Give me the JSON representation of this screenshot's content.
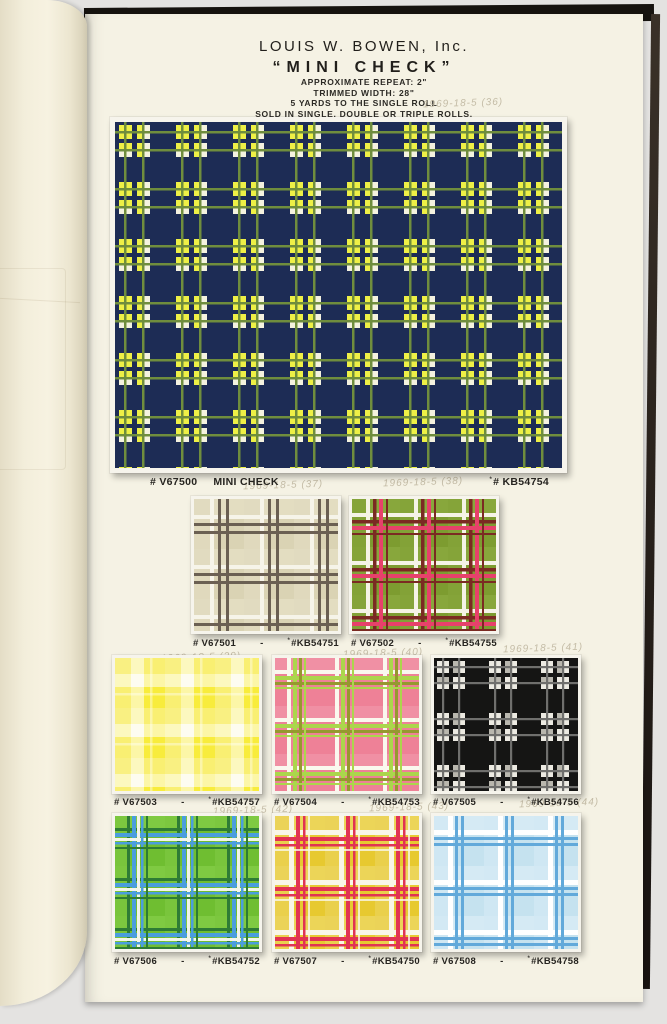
{
  "header": {
    "company": "LOUIS W. BOWEN, Inc.",
    "title": "“MINI CHECK”",
    "specs": [
      "APPROXIMATE REPEAT: 2\"",
      "TRIMMED WIDTH: 28\"",
      "5 YARDS TO THE SINGLE ROLL",
      "SOLD IN SINGLE, DOUBLE OR TRIPLE ROLLS."
    ],
    "footnote": "\"Kent Bragline, Inc. Correlated Fabrics Indicated by KB Numbers\""
  },
  "annotations": {
    "a36": "1969-18-5 (36)",
    "a37": "1969-18-5 (37)",
    "a38": "1969-18-5 (38)",
    "a39": "1969-18-5 (39)",
    "a40": "1969-18-5 (40)",
    "a41": "1969-18-5 (41)",
    "a42": "1969-18-5 (42)",
    "a43": "1969-18-5 (43)",
    "a44": "1969-18-5 (44)"
  },
  "main_swatch": {
    "v_number": "# V67500",
    "name": "MINI CHECK",
    "kb_mark": "*",
    "kb_number": "# KB54754",
    "palette": {
      "bg": "#1d2c55",
      "yellow": "#eef046",
      "white": "#f4f2df",
      "green": "#6f8d3d"
    }
  },
  "swatches": [
    {
      "v_number": "# V67501",
      "sep": "-",
      "kb_mark": "*",
      "kb_number": "#KB54751",
      "palette": {
        "bg": "#dad3b4",
        "line": "#6b6053",
        "accent": "#f6f4e9"
      }
    },
    {
      "v_number": "# V67502",
      "sep": "-",
      "kb_mark": "*",
      "kb_number": "#KB54755",
      "palette": {
        "bg": "#7d9c30",
        "maroon": "#7b2a22",
        "pink": "#e7416b",
        "accent": "#f5f3e6"
      }
    },
    {
      "v_number": "# V67503",
      "sep": "-",
      "kb_mark": "*",
      "kb_number": "#KB54757",
      "palette": {
        "bg": "#f8ec3c",
        "accent": "#fdfcf0"
      }
    },
    {
      "v_number": "# V67504",
      "sep": "-",
      "kb_mark": "*",
      "kb_number": "#KB54753",
      "palette": {
        "bg": "#ee8197",
        "lime": "#abd64c",
        "olive": "#96982f",
        "accent": "#faf8ee"
      }
    },
    {
      "v_number": "# V67505",
      "sep": "-",
      "kb_mark": "*",
      "kb_number": "#KB54756",
      "palette": {
        "bg": "#151514",
        "gray": "#6f6f6d",
        "accent": "#eceae2"
      }
    },
    {
      "v_number": "# V67506",
      "sep": "-",
      "kb_mark": "*",
      "kb_number": "#KB54752",
      "palette": {
        "bg": "#6fbe31",
        "darkgreen": "#2e7c35",
        "blue": "#4a9ede",
        "accent": "#f2f5ea"
      }
    },
    {
      "v_number": "# V67507",
      "sep": "-",
      "kb_mark": "*",
      "kb_number": "#KB54750",
      "palette": {
        "bg": "#e7c930",
        "red": "#e13353",
        "accent": "#f9f6e8"
      }
    },
    {
      "v_number": "# V67508",
      "sep": "-",
      "kb_mark": "*",
      "kb_number": "#KB54758",
      "palette": {
        "bg": "#c5e2ef",
        "blue": "#62a9da",
        "accent": "#ffffff"
      }
    }
  ]
}
